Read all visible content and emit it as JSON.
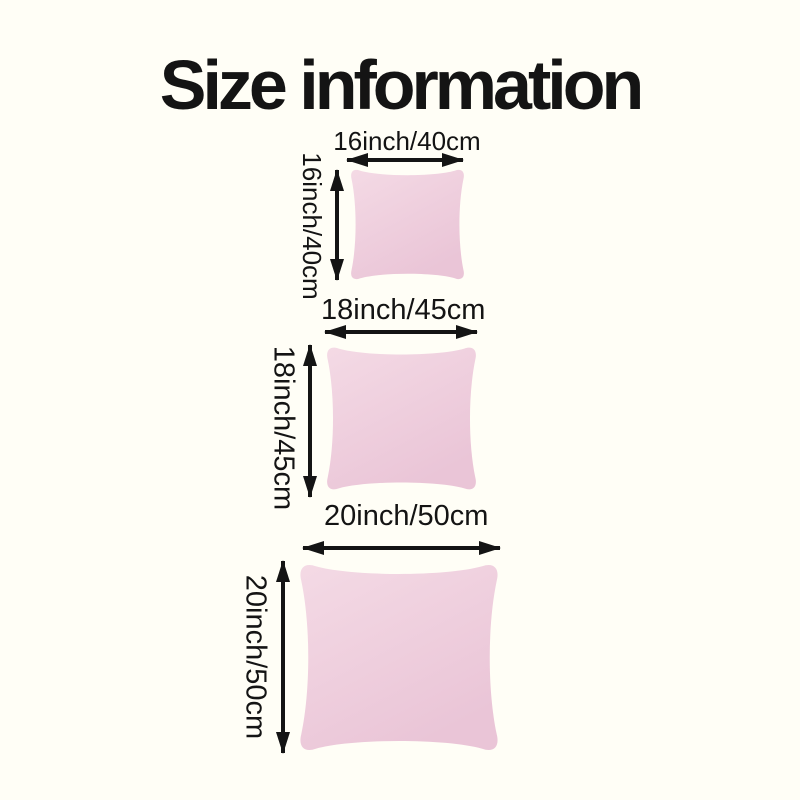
{
  "page": {
    "title": "Size information",
    "background_color": "#fffef6",
    "text_color": "#141414"
  },
  "colors": {
    "arrow": "#141414",
    "pillow_light": "#f4dae5",
    "pillow_dark": "#eac5d7"
  },
  "sizes": [
    {
      "name": "16-inch",
      "width_label": "16inch/40cm",
      "height_label": "16inch/40cm"
    },
    {
      "name": "18-inch",
      "width_label": "18inch/45cm",
      "height_label": "18inch/45cm"
    },
    {
      "name": "20-inch",
      "width_label": "20inch/50cm",
      "height_label": "20inch/50cm"
    }
  ]
}
